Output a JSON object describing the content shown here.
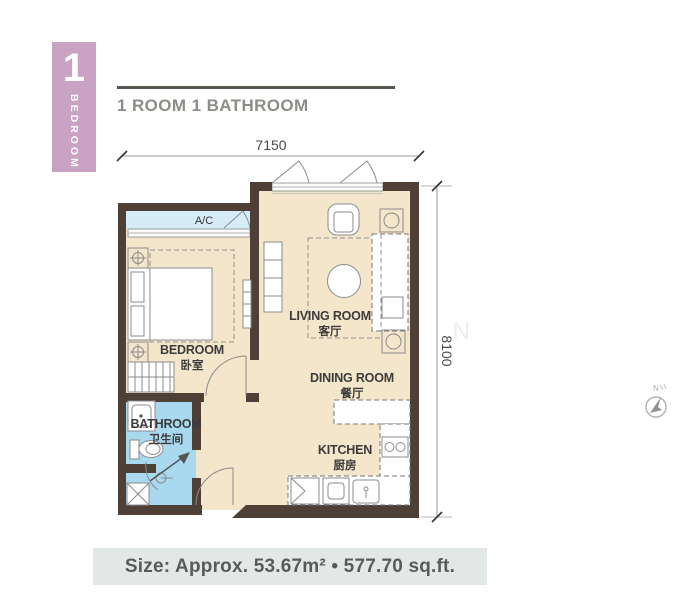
{
  "badge": {
    "number": "1",
    "label": "BEDROOM"
  },
  "header": {
    "title": "1 ROOM 1 BATHROOM"
  },
  "dimensions": {
    "top": "7150",
    "right": "8100"
  },
  "rooms": {
    "ac": {
      "en": "A/C"
    },
    "living": {
      "en": "LIVING ROOM",
      "zh": "客厅"
    },
    "dining": {
      "en": "DINING ROOM",
      "zh": "餐厅"
    },
    "kitchen": {
      "en": "KITCHEN",
      "zh": "厨房"
    },
    "bedroom": {
      "en": "BEDROOM",
      "zh": "卧室"
    },
    "bathroom": {
      "en": "BATHROOM",
      "zh": "卫生间"
    }
  },
  "compass": {
    "label": "N"
  },
  "footer": {
    "size": "Size: Approx. 53.67m²  •  577.70 sq.ft."
  },
  "watermark": {
    "letters": [
      "L",
      "A",
      "M",
      "E",
      "S",
      "O",
      "N"
    ]
  },
  "colors": {
    "badge": "#c9a2c4",
    "wall": "#4e4036",
    "floor": "#f4e6ca",
    "wet_floor": "#a9d9ef",
    "ac_floor": "#d6edf8",
    "title_text": "#8d8d87",
    "footer_bg": "#e3e8e7",
    "footer_text": "#575c5a"
  }
}
